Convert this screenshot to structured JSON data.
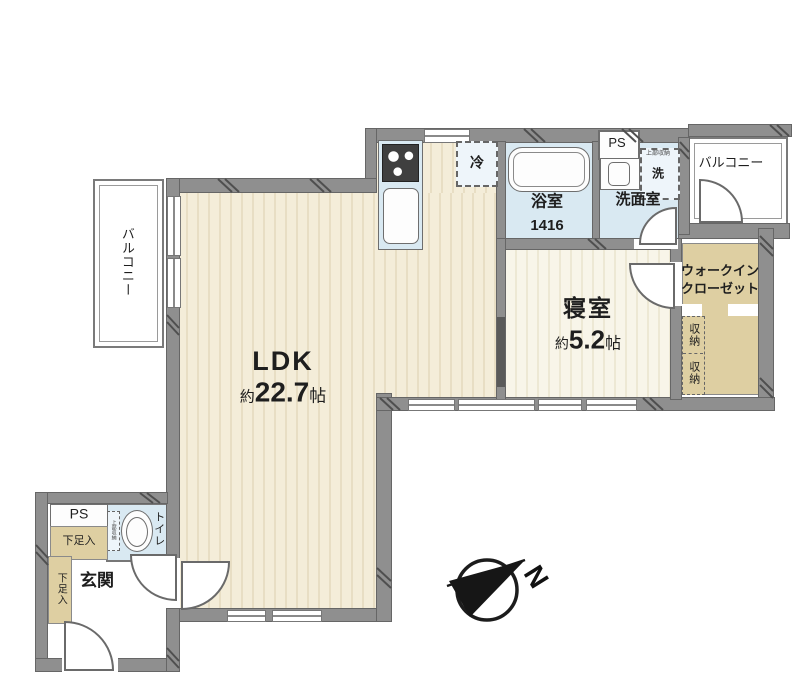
{
  "rooms": {
    "ldk": {
      "name": "LDK",
      "size_prefix": "約",
      "size_value": "22.7",
      "size_unit": "帖"
    },
    "bedroom": {
      "name": "寝室",
      "size_prefix": "約",
      "size_value": "5.2",
      "size_unit": "帖"
    },
    "bath": {
      "name": "浴室",
      "size": "1416"
    },
    "washroom": {
      "name": "洗面室"
    },
    "toilet": {
      "name": "トイレ",
      "note": "上部収納"
    },
    "entrance": {
      "name": "玄関"
    },
    "wic": {
      "name_line1": "ウォークイン",
      "name_line2": "クローゼット"
    },
    "storage_upper": {
      "name": "収納"
    },
    "storage_lower": {
      "name": "収納"
    },
    "shoe_entrance_top": {
      "name": "下足入"
    },
    "shoe_entrance_side": {
      "name": "下足入"
    },
    "balcony_left": {
      "name": "バルコニー"
    },
    "balcony_right": {
      "name": "バルコニー"
    },
    "ps_upper": {
      "name": "PS"
    },
    "ps_lower": {
      "name": "PS"
    }
  },
  "fixtures": {
    "fridge": {
      "label": "冷"
    },
    "washer": {
      "label": "洗",
      "note": "上部収納"
    }
  },
  "compass": {
    "north_label": "N"
  },
  "colors": {
    "wall": "#8f8f8f",
    "floor_ldk": "#f4edd9",
    "floor_bedroom": "#f8f5e9",
    "wet_room": "#d9e9f2",
    "storage_tan": "#decfa2",
    "line": "#666666"
  }
}
